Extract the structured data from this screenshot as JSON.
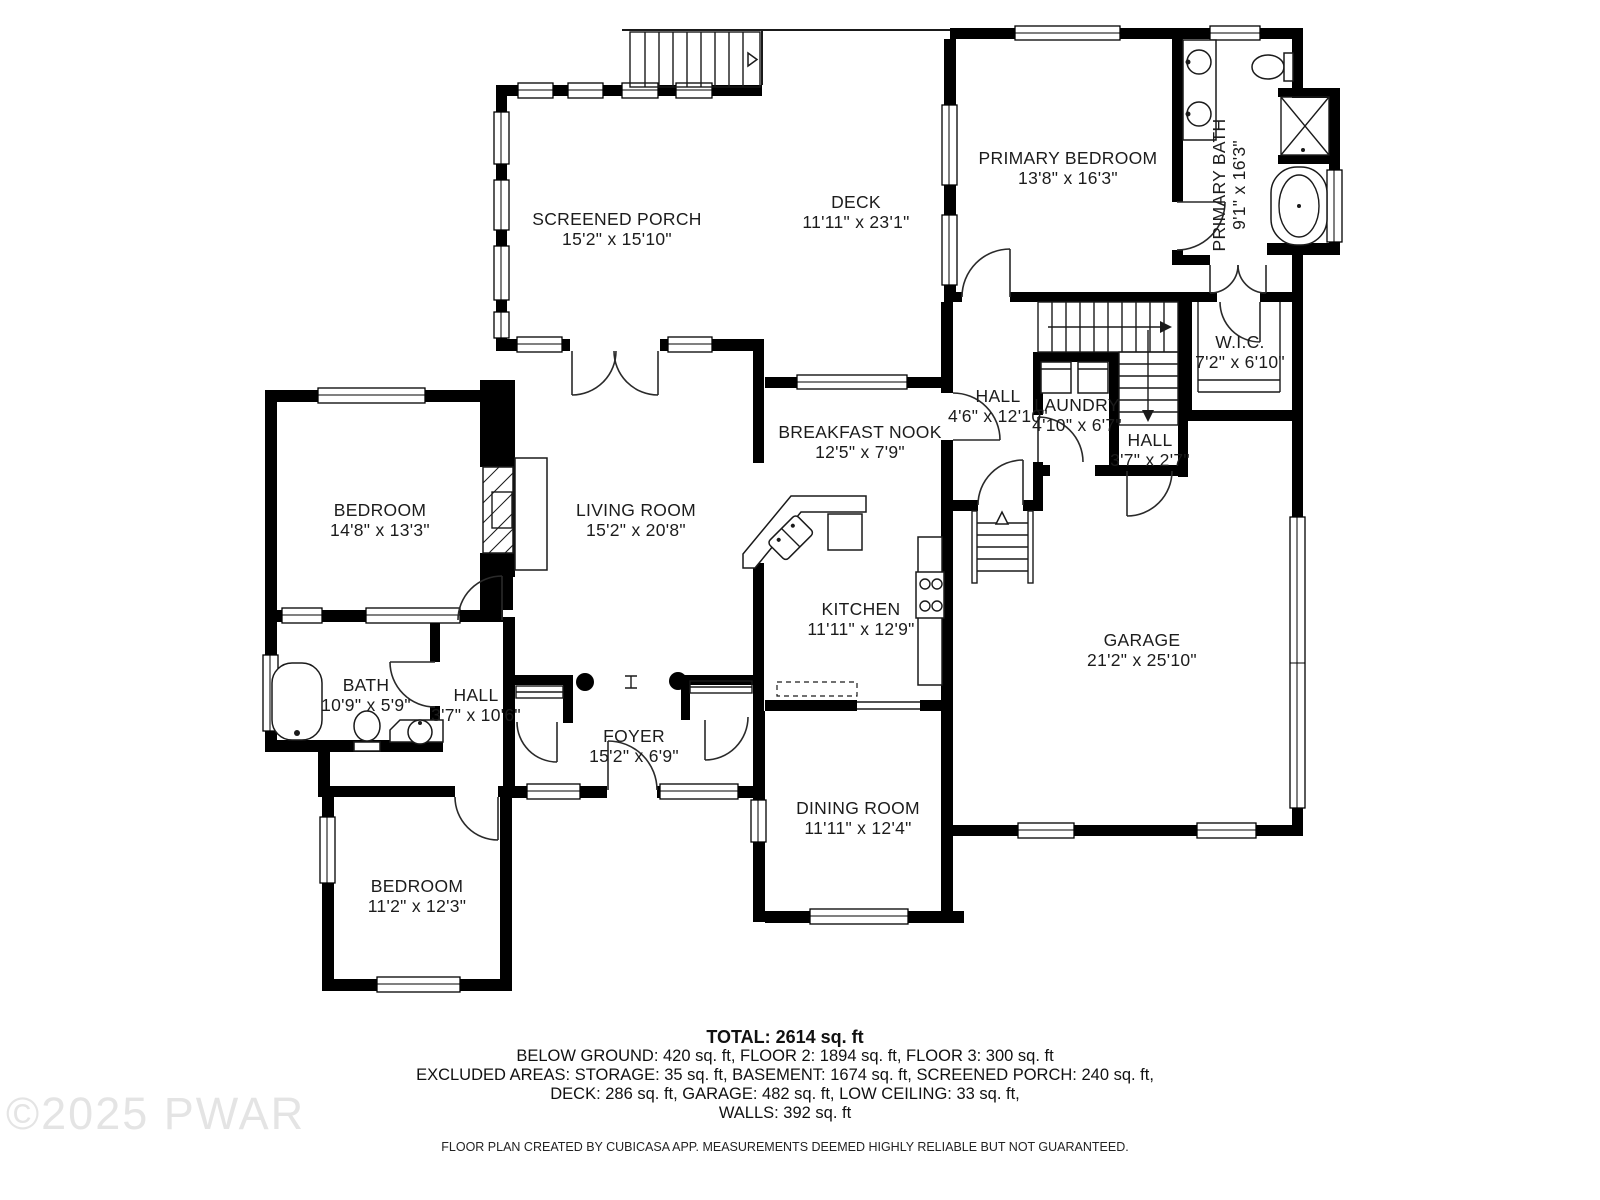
{
  "floor_plan": {
    "rooms": [
      {
        "id": "screened-porch",
        "name": "SCREENED PORCH",
        "dims": "15'2\" x 15'10\""
      },
      {
        "id": "deck",
        "name": "DECK",
        "dims": "11'11\" x 23'1\""
      },
      {
        "id": "primary-bedroom",
        "name": "PRIMARY BEDROOM",
        "dims": "13'8\" x 16'3\""
      },
      {
        "id": "primary-bath",
        "name": "PRIMARY BATH",
        "dims": "9'1\" x 16'3\""
      },
      {
        "id": "wic",
        "name": "W.I.C.",
        "dims": "7'2\" x 6'10\""
      },
      {
        "id": "hall-upper",
        "name": "HALL",
        "dims": "4'6\" x 12'10\""
      },
      {
        "id": "laundry",
        "name": "LAUNDRY",
        "dims": "4'10\" x 6'7\""
      },
      {
        "id": "hall-small",
        "name": "HALL",
        "dims": "3'7\" x 2'7\""
      },
      {
        "id": "bedroom-left",
        "name": "BEDROOM",
        "dims": "14'8\" x 13'3\""
      },
      {
        "id": "living-room",
        "name": "LIVING ROOM",
        "dims": "15'2\" x 20'8\""
      },
      {
        "id": "breakfast-nook",
        "name": "BREAKFAST NOOK",
        "dims": "12'5\" x 7'9\""
      },
      {
        "id": "kitchen",
        "name": "KITCHEN",
        "dims": "11'11\" x 12'9\""
      },
      {
        "id": "bath",
        "name": "BATH",
        "dims": "10'9\" x 5'9\""
      },
      {
        "id": "hall-lower",
        "name": "HALL",
        "dims": "3'7\" x 10'6\""
      },
      {
        "id": "foyer",
        "name": "FOYER",
        "dims": "15'2\" x 6'9\""
      },
      {
        "id": "bedroom-lower",
        "name": "BEDROOM",
        "dims": "11'2\" x 12'3\""
      },
      {
        "id": "dining-room",
        "name": "DINING ROOM",
        "dims": "11'11\" x 12'4\""
      },
      {
        "id": "garage",
        "name": "GARAGE",
        "dims": "21'2\" x 25'10\""
      }
    ]
  },
  "summary": {
    "total": "TOTAL: 2614 sq. ft",
    "line_floors": "BELOW GROUND: 420 sq. ft, FLOOR 2: 1894 sq. ft, FLOOR 3: 300 sq. ft",
    "line_excluded_1": "EXCLUDED AREAS: STORAGE: 35 sq. ft, BASEMENT: 1674 sq. ft, SCREENED PORCH: 240 sq. ft,",
    "line_excluded_2": "DECK: 286 sq. ft, GARAGE: 482 sq. ft, LOW CEILING: 33 sq. ft,",
    "line_walls": "WALLS: 392 sq. ft",
    "disclaimer": "FLOOR PLAN CREATED BY CUBICASA APP. MEASUREMENTS DEEMED HIGHLY RELIABLE BUT NOT GUARANTEED."
  },
  "watermark": "©2025 PWAR",
  "colors": {
    "walls": "#000000",
    "background": "#ffffff",
    "text": "#1c1c1c",
    "watermark": "#e4e4e4"
  }
}
